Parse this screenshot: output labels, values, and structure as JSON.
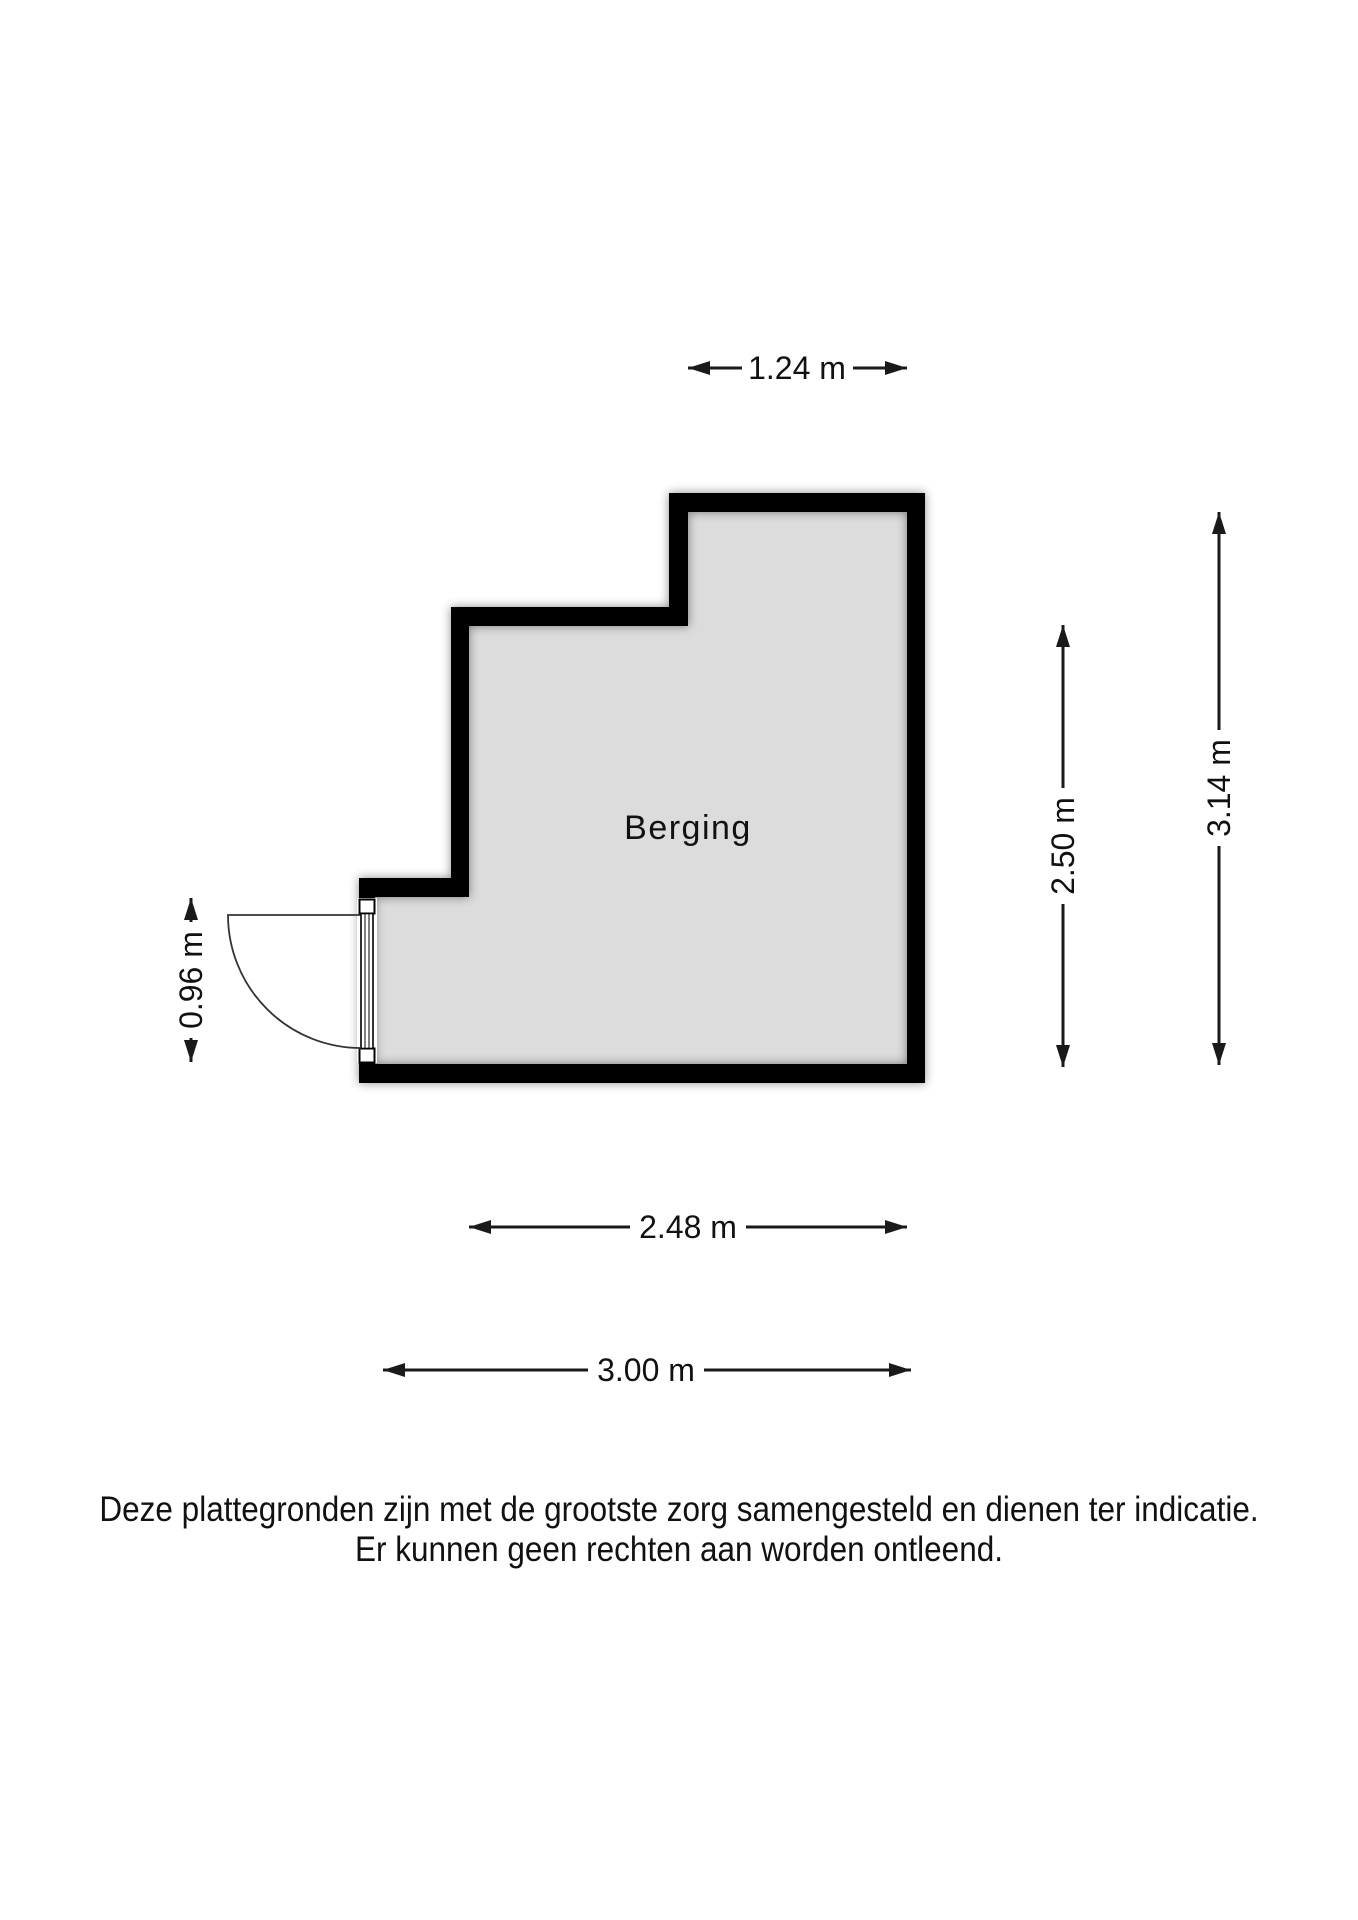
{
  "floorplan": {
    "room_label": "Berging",
    "dimensions": {
      "top_width": "1.24 m",
      "right_inner_height": "2.50 m",
      "right_outer_height": "3.14 m",
      "door_opening": "0.96 m",
      "bottom_inner_width": "2.48 m",
      "bottom_outer_width": "3.00 m"
    },
    "colors": {
      "wall": "#000000",
      "floor_fill": "#dcdcdc",
      "dimension_lines": "#1a1a1a"
    }
  },
  "disclaimer": {
    "line1": "Deze plattegronden zijn met de grootste zorg samengesteld en dienen ter indicatie.",
    "line2": "Er kunnen geen rechten aan worden ontleend."
  }
}
